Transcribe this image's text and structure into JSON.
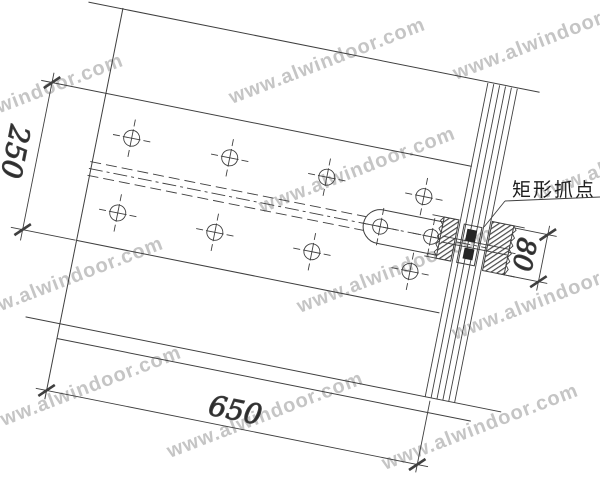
{
  "meta": {
    "description": "CAD detail drawing of a curtain-wall panel connection with rectangular grip fitting",
    "canvas": {
      "width": 600,
      "height": 477
    }
  },
  "colors": {
    "background": "#ffffff",
    "line": "#3f3f3f",
    "watermark": "#c5c5c5",
    "text": "#2b2b2b"
  },
  "watermark": {
    "text": "www.alwindoor.com"
  },
  "annotations": {
    "grip_label": "矩形抓点"
  },
  "dimensions": {
    "plate_width": "250",
    "span": "650",
    "grip_height": "80"
  }
}
